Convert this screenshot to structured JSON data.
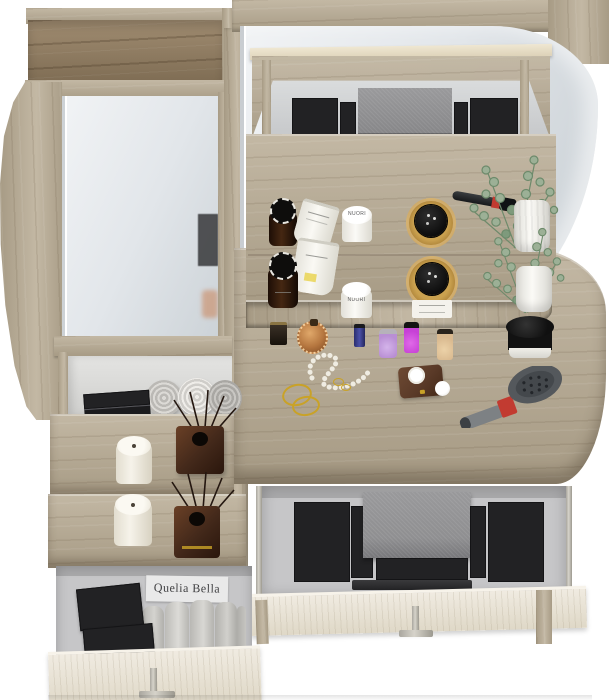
{
  "visible_text": {
    "brand_card": "Quelia Bella",
    "jar_brand": "NUORI"
  },
  "colors": {
    "wood_light": "#c3b8a4",
    "wood_mid": "#a79b85",
    "wood_dark_hi": "#a08c71",
    "wood_dark_lo": "#7e6c53",
    "drawer_hi": "#f0ebe1",
    "drawer_lo": "#dfd8c7",
    "mirror_light": "#f1f3f5",
    "mirror_dark": "#c6cdd2",
    "interior_gray": "#c6c6c8",
    "interior_wall": "#a9a9ab",
    "case_gray": "#8f8f91",
    "towel_light": "#dedcd8",
    "towel_gray": "#b7b5b1",
    "candle_white": "#f3efe6",
    "diffuser_brown": "#42281a",
    "plant_green": "#9cb096",
    "plant_green_dark": "#7e9a7c",
    "vase_white": "#f2f1ee",
    "amber_glass": "#b07f35",
    "bottle_dark": "#2a160c",
    "brush_head": "#54585c",
    "brush_handle": "#7d8184",
    "accent_red": "#c23b31",
    "gold": "#c9a227",
    "pearl": "#efece2",
    "leather": "#5a3a28",
    "handle_metal": "#c6c3bb",
    "card_bg": "#e9e9e9",
    "polish_blue": "#3a3f8f",
    "polish_lilac": "#b98fd4",
    "polish_magenta": "#c741d6",
    "polish_beige": "#d9b98f",
    "copper": "#b5763f"
  },
  "palettes": {
    "upper_left": {
      "cols": 2,
      "colors": [
        "#d77f52",
        "#e8b78e",
        "#c96a45",
        "#f0c9a6",
        "#b05b3e",
        "#e2a87e",
        "#9c4a34",
        "#d99a74"
      ]
    },
    "upper_right": {
      "cols": 2,
      "colors": [
        "#b8442f",
        "#e59a70",
        "#a03828",
        "#d98a62",
        "#c26442",
        "#f0c5a2",
        "#8e3a2a",
        "#c97a52"
      ]
    },
    "upper_strip": {
      "cols": 1,
      "colors": [
        "#caa06e",
        "#b58455",
        "#9c6a42",
        "#85552f"
      ]
    },
    "drawer_left": {
      "cols": 2,
      "colors": [
        "#a8502f",
        "#e8b48e",
        "#c98e5f",
        "#f2d4b4",
        "#b06a42",
        "#edbf9a",
        "#d9825f",
        "#f4d2c2",
        "#e09a78",
        "#f0c4ae",
        "#f2d9c4",
        "#f7e7d6"
      ]
    },
    "drawer_right": {
      "cols": 2,
      "colors": [
        "#8e3022",
        "#c2512f",
        "#a83c28",
        "#d97a4f",
        "#c05f38",
        "#edaf84",
        "#d08252",
        "#f2c9a8",
        "#e2a478",
        "#f4d6ba",
        "#eec49e",
        "#f7e2cc"
      ]
    },
    "drawer_strip_left": {
      "cols": 1,
      "colors": [
        "#b98c5a",
        "#a5764a",
        "#8e6240",
        "#7a5236",
        "#684430"
      ]
    },
    "drawer_strip_right": {
      "cols": 1,
      "colors": [
        "#c49a6a",
        "#ab7e50",
        "#926844",
        "#7e5638",
        "#6a4630"
      ]
    },
    "drawer_under_row": {
      "cols": 3,
      "colors": [
        "#5f5a40",
        "#dcdcd4",
        "#6a5348"
      ]
    },
    "left_drawer_plum": {
      "cols": 5,
      "colors": [
        "#7e4a5c",
        "#9a6274",
        "#5c3140",
        "#b4848f",
        "#8e5468",
        "#6a3a4a",
        "#c49aa4",
        "#744252",
        "#a4707e",
        "#56293a",
        "#8a5064",
        "#b08694",
        "#643448",
        "#9c6a78",
        "#4e2432"
      ]
    },
    "left_drawer_orange": {
      "cols": 5,
      "colors": [
        "#c2702f",
        "#8e4f24",
        "#d9953f",
        "#a4622c",
        "#6e3f1f",
        "#e0a854",
        "#b5762f",
        "#8a4a20",
        "#caa05c",
        "#5e3318",
        "#d28a3a",
        "#9a5c28",
        "#c07a34",
        "#7a4520",
        "#b06a2a"
      ]
    },
    "niche_palette_row": {
      "cols": 6,
      "colors": [
        "#c2702f",
        "#8e4f24",
        "#d9953f",
        "#6e3f1f",
        "#b5762f",
        "#2a2a2a"
      ]
    },
    "mirror_reflection_strip": {
      "cols": 1,
      "colors": [
        "#d9945f",
        "#b56a3e",
        "#e0a87a",
        "#9c5532",
        "#caa06e"
      ]
    }
  }
}
